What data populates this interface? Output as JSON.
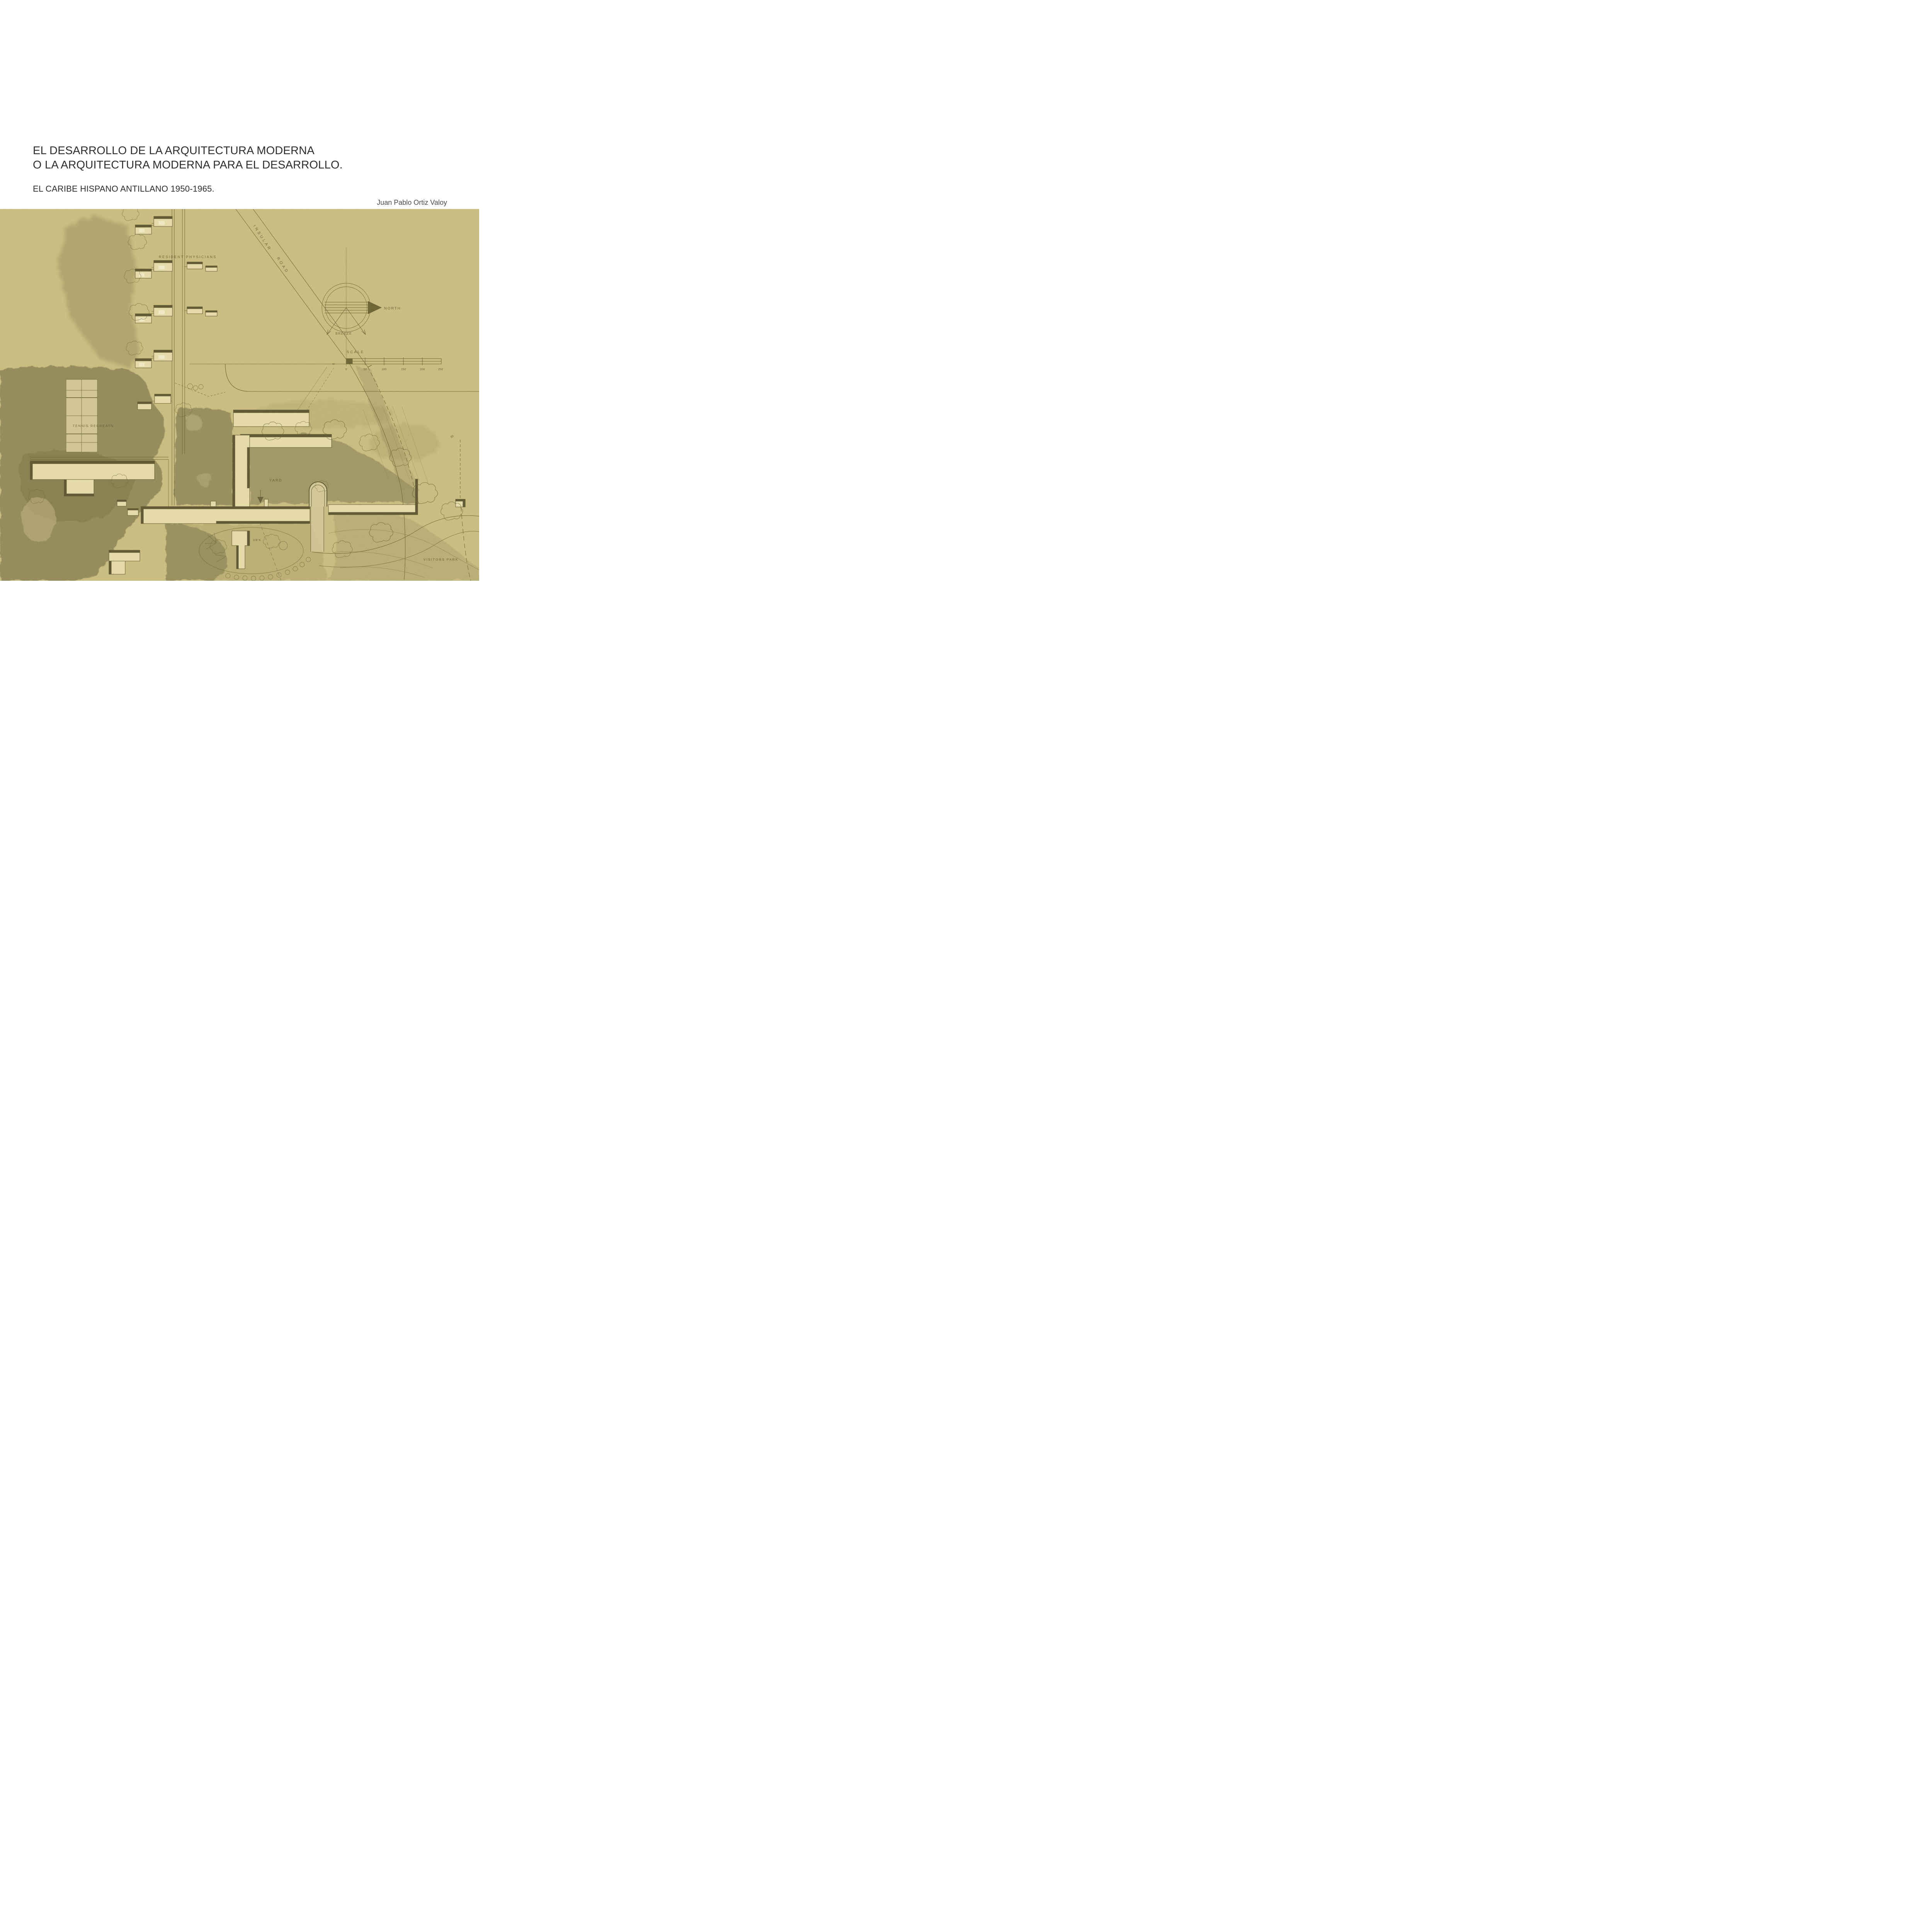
{
  "page": {
    "title_line1": "EL DESARROLLO DE LA ARQUITECTURA MODERNA",
    "title_line2": "O LA ARQUITECTURA MODERNA PARA EL DESARROLLO.",
    "subtitle": "EL CARIBE HISPANO ANTILLANO 1950-1965.",
    "author": "Juan Pablo Ortiz Valoy"
  },
  "plan": {
    "labels": {
      "resident_physicians": "RESIDENT PHYSICIANS",
      "insular": "INSULAR",
      "road": "ROAD",
      "north": "NORTH",
      "breeze": "BREEZE",
      "scale": "SCALE",
      "zero_mark": "0",
      "tennis": "TENNIS RECREATN",
      "yard": "YARD",
      "dbk": "DB'K",
      "visitors": "VISITORS PARK",
      "elevation_85": "85"
    },
    "scale_ticks": [
      "0",
      "50",
      "100",
      "150",
      "200",
      "250"
    ],
    "colors": {
      "paper": "#cdc084",
      "building": "#eadfad",
      "building_light": "#f4edca",
      "ink": "#5f5832",
      "vegetation": "#8d8455",
      "shade": "#b9ae79"
    }
  }
}
